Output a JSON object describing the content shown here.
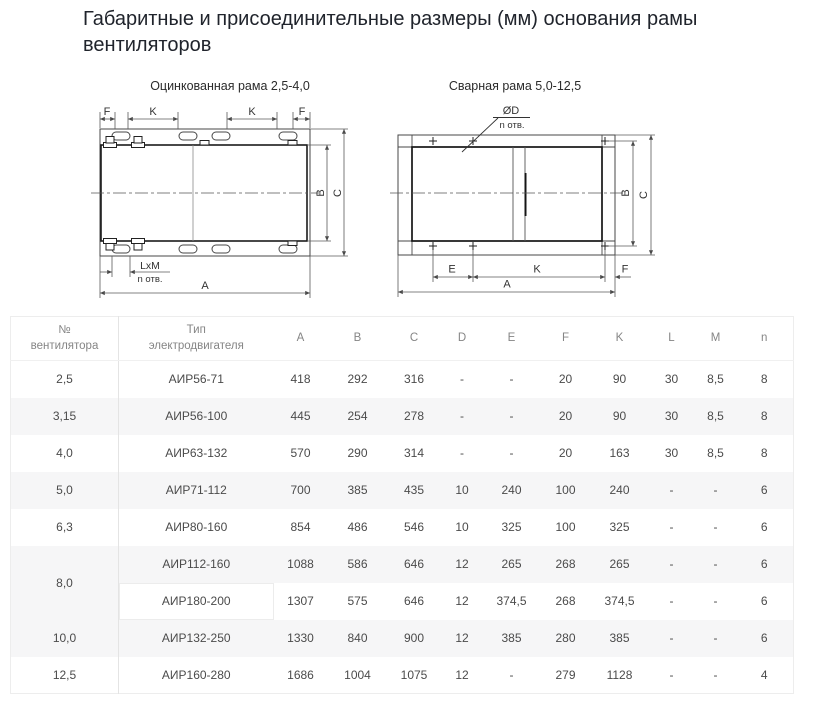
{
  "page": {
    "title": "Габаритные и присоединительные размеры (мм) основания рамы вентиляторов"
  },
  "diagrams": {
    "galvanized": {
      "title": "Оцинкованная рама 2,5-4,0",
      "labels": {
        "f_left": "F",
        "k_left": "K",
        "k_right": "K",
        "f_right": "F",
        "b": "B",
        "c": "C",
        "a": "A",
        "lxm": "LxM",
        "holes": "n отв."
      }
    },
    "welded": {
      "title": "Сварная рама 5,0-12,5",
      "labels": {
        "d": "ØD",
        "holes": "n отв.",
        "b": "B",
        "c": "C",
        "e": "E",
        "k": "K",
        "f": "F",
        "a": "A"
      }
    }
  },
  "table": {
    "headers": [
      "№\nвентилятора",
      "Тип\nэлектродвигателя",
      "A",
      "B",
      "C",
      "D",
      "E",
      "F",
      "K",
      "L",
      "M",
      "n"
    ],
    "rows": [
      {
        "no": "2,5",
        "type": "АИР56-71",
        "values": [
          "418",
          "292",
          "316",
          "-",
          "-",
          "20",
          "90",
          "30",
          "8,5",
          "8"
        ]
      },
      {
        "no": "3,15",
        "type": "АИР56-100",
        "values": [
          "445",
          "254",
          "278",
          "-",
          "-",
          "20",
          "90",
          "30",
          "8,5",
          "8"
        ]
      },
      {
        "no": "4,0",
        "type": "АИР63-132",
        "values": [
          "570",
          "290",
          "314",
          "-",
          "-",
          "20",
          "163",
          "30",
          "8,5",
          "8"
        ]
      },
      {
        "no": "5,0",
        "type": "АИР71-112",
        "values": [
          "700",
          "385",
          "435",
          "10",
          "240",
          "100",
          "240",
          "-",
          "-",
          "6"
        ]
      },
      {
        "no": "6,3",
        "type": "АИР80-160",
        "values": [
          "854",
          "486",
          "546",
          "10",
          "325",
          "100",
          "325",
          "-",
          "-",
          "6"
        ]
      },
      {
        "no": "8,0",
        "rowspan": 2,
        "type": "АИР112-160",
        "values": [
          "1088",
          "586",
          "646",
          "12",
          "265",
          "268",
          "265",
          "-",
          "-",
          "6"
        ]
      },
      {
        "no": null,
        "type": "АИР180-200",
        "highlight": true,
        "values": [
          "1307",
          "575",
          "646",
          "12",
          "374,5",
          "268",
          "374,5",
          "-",
          "-",
          "6"
        ]
      },
      {
        "no": "10,0",
        "type": "АИР132-250",
        "values": [
          "1330",
          "840",
          "900",
          "12",
          "385",
          "280",
          "385",
          "-",
          "-",
          "6"
        ]
      },
      {
        "no": "12,5",
        "type": "АИР160-280",
        "values": [
          "1686",
          "1004",
          "1075",
          "12",
          "-",
          "279",
          "1128",
          "-",
          "-",
          "4"
        ]
      }
    ]
  }
}
